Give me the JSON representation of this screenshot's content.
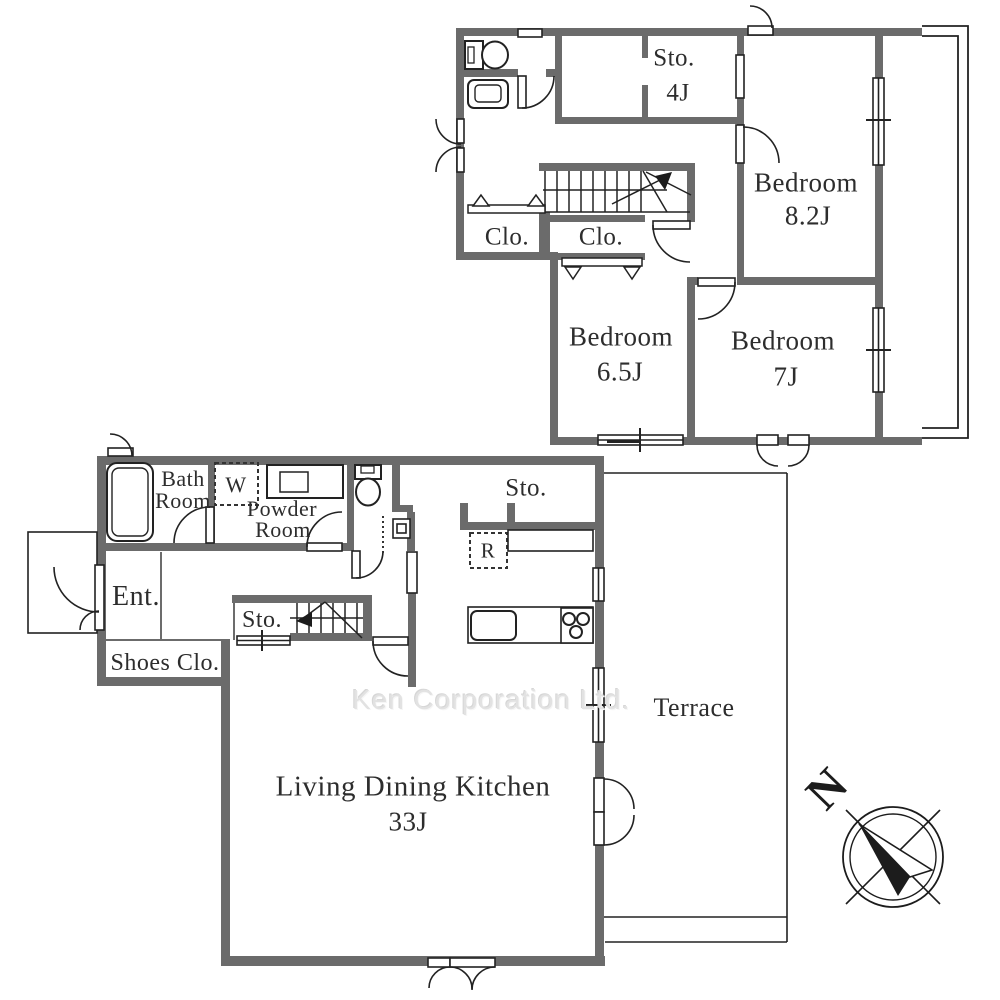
{
  "watermark": "Ken Corporation Ltd.",
  "compass": {
    "north": "N"
  },
  "floor2": {
    "storage_label": "Sto.",
    "storage_size": "4J",
    "bedroom_a_label": "Bedroom",
    "bedroom_a_size": "8.2J",
    "bedroom_b_label": "Bedroom",
    "bedroom_b_size": "6.5J",
    "bedroom_c_label": "Bedroom",
    "bedroom_c_size": "7J",
    "closet_left_label": "Clo.",
    "closet_mid_label": "Clo."
  },
  "floor1": {
    "bath_line1": "Bath",
    "bath_line2": "Room",
    "washer_label": "W",
    "powder_line1": "Powder",
    "powder_line2": "Room",
    "entrance_label": "Ent.",
    "shoes_closet_label": "Shoes Clo.",
    "under_stair_storage_label": "Sto.",
    "kitchen_storage_label": "Sto.",
    "refrigerator_label": "R",
    "ldk_label": "Living Dining Kitchen",
    "ldk_size": "33J",
    "terrace_label": "Terrace"
  },
  "colors": {
    "wall": "#6b6b6b",
    "line": "#222222",
    "watermark": "#e2e2e2",
    "text": "#2d2d2d"
  }
}
